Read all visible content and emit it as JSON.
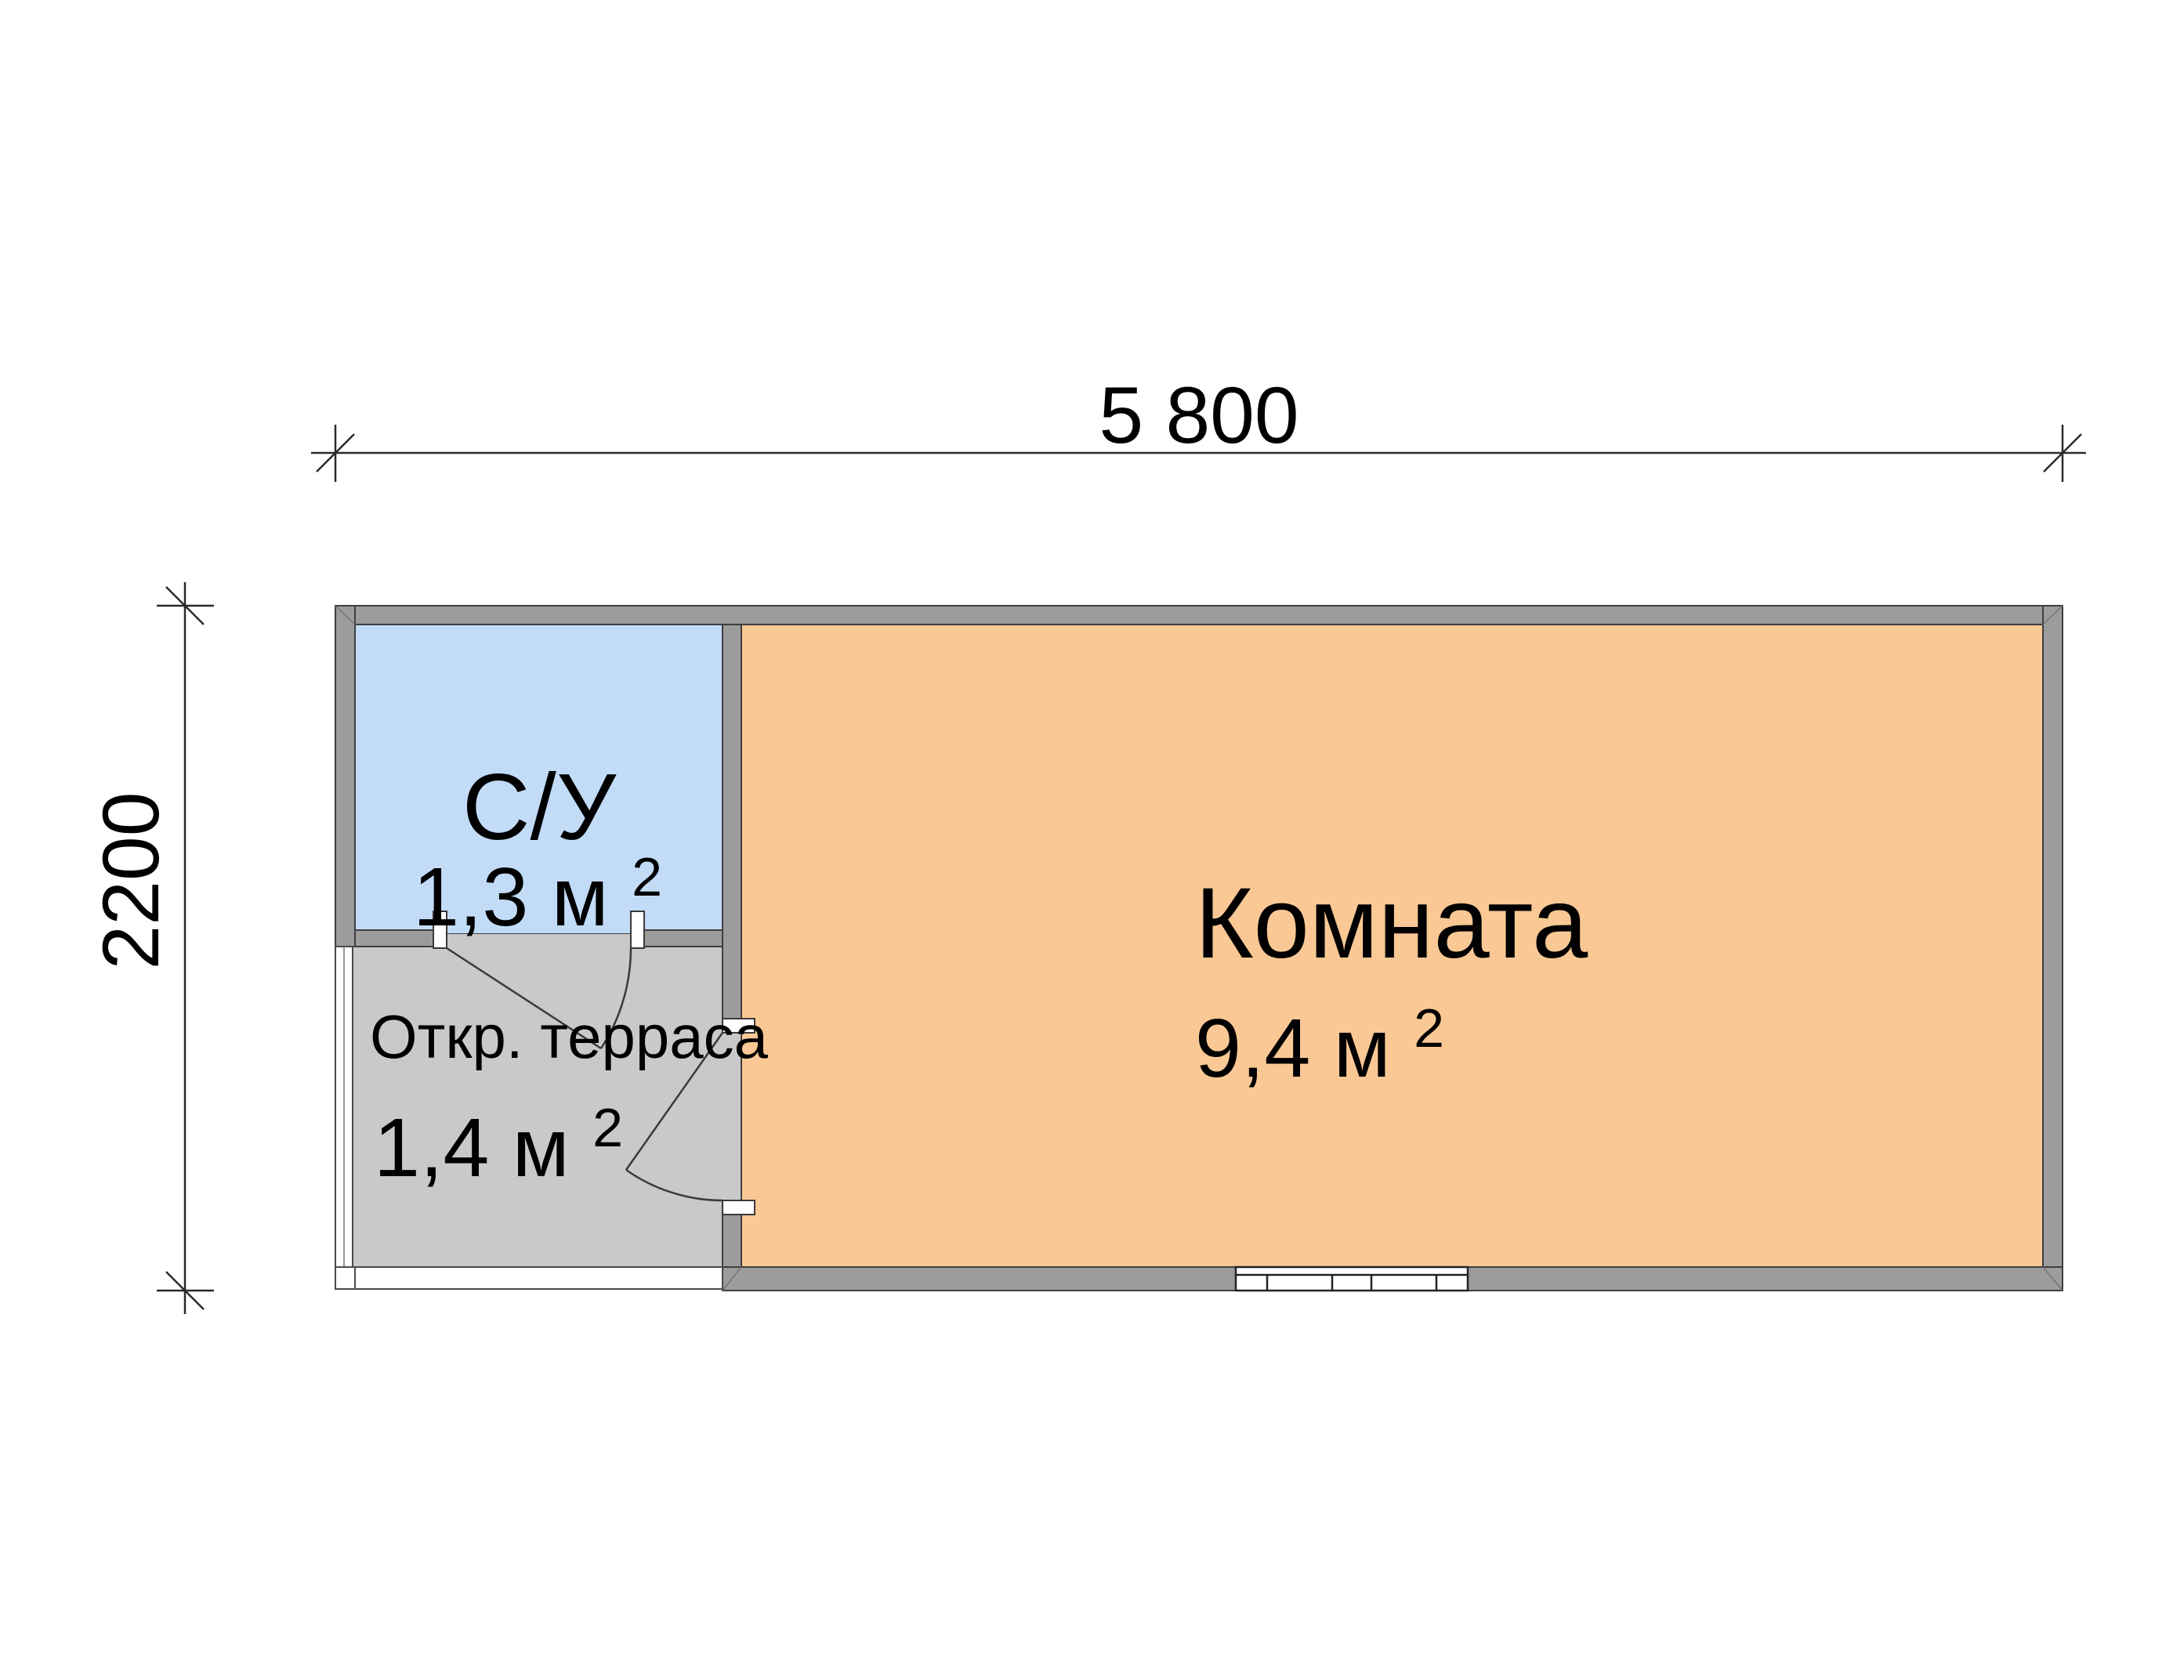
{
  "dimensions": {
    "width": {
      "label": "5 800"
    },
    "height": {
      "label": "2200"
    }
  },
  "rooms": {
    "bathroom": {
      "name": "С/У",
      "area": "1,3 м",
      "area_sup": "2"
    },
    "living": {
      "name": "Комната",
      "area": "9,4 м",
      "area_sup": "2"
    },
    "terrace": {
      "name": "Откр. терраса",
      "area": "1,4 м",
      "area_sup": "2"
    }
  },
  "colors": {
    "bathroom_fill": "#c2dcf8",
    "living_fill": "#f9c894",
    "terrace_fill": "#c9c9c9",
    "wall_fill": "#9c9c9c",
    "outline": "#3f3f3f"
  }
}
